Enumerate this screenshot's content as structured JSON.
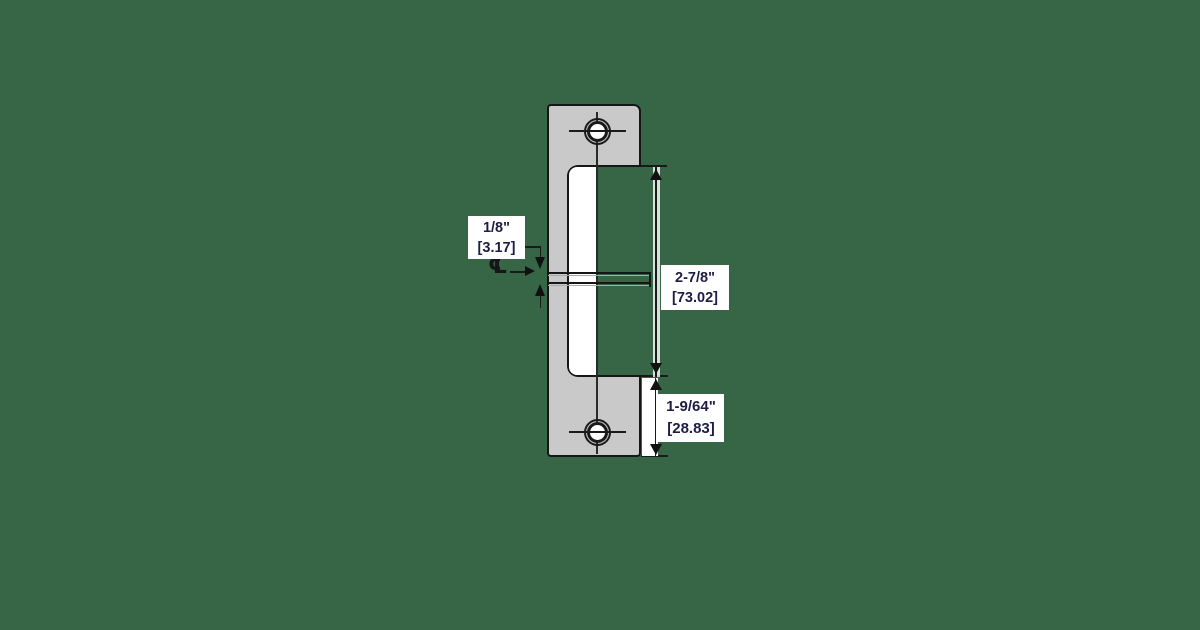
{
  "background_color": "#376646",
  "drawing": {
    "type": "technical-dimension-diagram",
    "subject": "electric-strike-faceplate-front-view",
    "plate_fill": "#c9c9c9",
    "line_color": "#1a1a1a",
    "label_text_color": "#1d1d45",
    "label_background": "#ffffff",
    "centerline_symbol": "℄"
  },
  "dimensions": {
    "keeper_offset": {
      "inches": "1/8\"",
      "mm_bracket": "[3.17]"
    },
    "opening_height": {
      "inches": "2-7/8\"",
      "mm_bracket": "[73.02]"
    },
    "bottom_section": {
      "inches": "1-9/64\"",
      "mm_bracket": "[28.83]"
    }
  }
}
